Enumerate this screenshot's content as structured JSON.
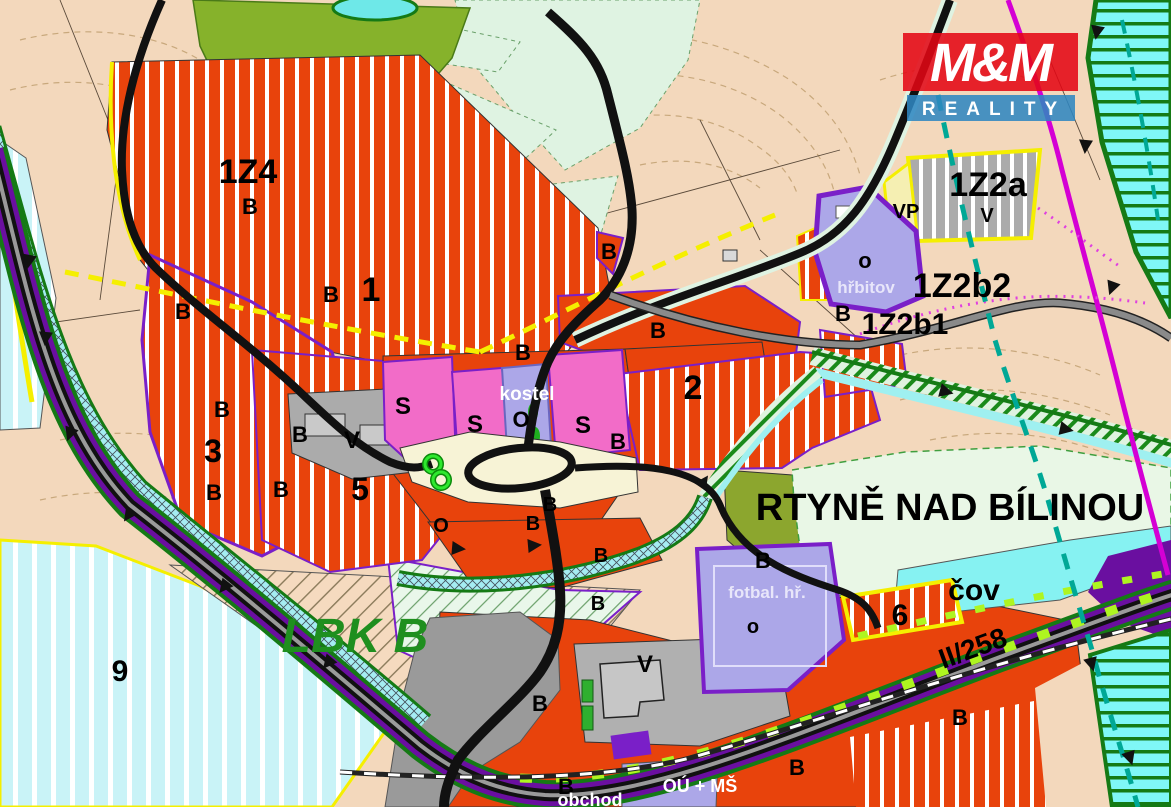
{
  "logo": {
    "mm": "M&M",
    "reality": "REALITY",
    "red": "#e30613",
    "blue": "#2e86c1"
  },
  "map": {
    "town_name": "RTYNĚ NAD BÍLINOU",
    "biocorridor_name": "LBK B",
    "road_code": "II/258",
    "labels": [
      {
        "t": "1Z4",
        "x": 248,
        "y": 183,
        "s": 34,
        "id": "zone-code-1z4"
      },
      {
        "t": "1Z2a",
        "x": 988,
        "y": 196,
        "s": 34,
        "id": "zone-code-1z2a"
      },
      {
        "t": "1Z2b2",
        "x": 962,
        "y": 297,
        "s": 34,
        "id": "zone-code-1z2b2"
      },
      {
        "t": "1Z2b1",
        "x": 905,
        "y": 334,
        "s": 30,
        "id": "zone-code-1z2b1"
      },
      {
        "t": "VP",
        "x": 906,
        "y": 218,
        "s": 20,
        "id": "zone-code-vp"
      },
      {
        "t": "1",
        "x": 371,
        "y": 301,
        "s": 34,
        "id": "area-1"
      },
      {
        "t": "2",
        "x": 693,
        "y": 399,
        "s": 34,
        "id": "area-2"
      },
      {
        "t": "3",
        "x": 213,
        "y": 462,
        "s": 32,
        "id": "area-3"
      },
      {
        "t": "5",
        "x": 360,
        "y": 500,
        "s": 32,
        "id": "area-5"
      },
      {
        "t": "6",
        "x": 900,
        "y": 625,
        "s": 30,
        "id": "area-6"
      },
      {
        "t": "9",
        "x": 120,
        "y": 681,
        "s": 30,
        "id": "area-9"
      },
      {
        "t": "B",
        "x": 250,
        "y": 214,
        "s": 22
      },
      {
        "t": "B",
        "x": 331,
        "y": 302,
        "s": 22
      },
      {
        "t": "B",
        "x": 183,
        "y": 319,
        "s": 22
      },
      {
        "t": "B",
        "x": 222,
        "y": 417,
        "s": 22
      },
      {
        "t": "B",
        "x": 300,
        "y": 442,
        "s": 22
      },
      {
        "t": "B",
        "x": 214,
        "y": 500,
        "s": 22
      },
      {
        "t": "B",
        "x": 281,
        "y": 497,
        "s": 22
      },
      {
        "t": "B",
        "x": 609,
        "y": 259,
        "s": 22
      },
      {
        "t": "B",
        "x": 523,
        "y": 360,
        "s": 22
      },
      {
        "t": "B",
        "x": 658,
        "y": 338,
        "s": 22
      },
      {
        "t": "B",
        "x": 618,
        "y": 449,
        "s": 22
      },
      {
        "t": "B",
        "x": 843,
        "y": 321,
        "s": 22
      },
      {
        "t": "B",
        "x": 763,
        "y": 568,
        "s": 22
      },
      {
        "t": "B",
        "x": 550,
        "y": 511,
        "s": 20
      },
      {
        "t": "B",
        "x": 533,
        "y": 530,
        "s": 20
      },
      {
        "t": "B",
        "x": 601,
        "y": 562,
        "s": 20
      },
      {
        "t": "B",
        "x": 598,
        "y": 610,
        "s": 20
      },
      {
        "t": "B",
        "x": 540,
        "y": 711,
        "s": 22
      },
      {
        "t": "B",
        "x": 797,
        "y": 775,
        "s": 22
      },
      {
        "t": "B",
        "x": 566,
        "y": 794,
        "s": 22
      },
      {
        "t": "B",
        "x": 960,
        "y": 725,
        "s": 22
      },
      {
        "t": "S",
        "x": 403,
        "y": 414,
        "s": 24
      },
      {
        "t": "S",
        "x": 475,
        "y": 432,
        "s": 24
      },
      {
        "t": "S",
        "x": 583,
        "y": 433,
        "s": 24
      },
      {
        "t": "V",
        "x": 352,
        "y": 448,
        "s": 24,
        "id": "v-label-west"
      },
      {
        "t": "V",
        "x": 987,
        "y": 222,
        "s": 20,
        "id": "v-label-1z2a"
      },
      {
        "t": "V",
        "x": 645,
        "y": 672,
        "s": 24,
        "id": "v-label-south"
      },
      {
        "t": "O",
        "x": 521,
        "y": 427,
        "s": 22,
        "id": "o-label-kostel"
      },
      {
        "t": "O",
        "x": 441,
        "y": 532,
        "s": 20,
        "id": "o-label-center"
      },
      {
        "t": "o",
        "x": 865,
        "y": 268,
        "s": 22,
        "id": "o-label-hrbitov"
      },
      {
        "t": "o",
        "x": 753,
        "y": 633,
        "s": 20,
        "id": "o-label-fotbal"
      },
      {
        "t": "kostel",
        "x": 527,
        "y": 400,
        "s": 19,
        "c": "#ffffff",
        "id": "name-kostel"
      },
      {
        "t": "hřbitov",
        "x": 866,
        "y": 293,
        "s": 17,
        "c": "#e8e6fa",
        "id": "name-hrbitov"
      },
      {
        "t": "fotbal. hř.",
        "x": 767,
        "y": 598,
        "s": 17,
        "c": "#e8e6fa",
        "id": "name-fotbal-hriste"
      },
      {
        "t": "OÚ + MŠ",
        "x": 700,
        "y": 792,
        "s": 18,
        "c": "#ffffff",
        "id": "name-ou-ms"
      },
      {
        "t": "obchod",
        "x": 590,
        "y": 806,
        "s": 18,
        "c": "#ffffff",
        "id": "name-obchod"
      },
      {
        "t": "čov",
        "x": 974,
        "y": 600,
        "s": 30,
        "id": "name-cov"
      },
      {
        "t": "RTYNĚ NAD BÍLINOU",
        "x": 950,
        "y": 520,
        "s": 38,
        "id": "town-name"
      },
      {
        "t": "LBK B",
        "x": 355,
        "y": 652,
        "s": 48,
        "c": "#1f8f1f",
        "it": true,
        "id": "biocorridor-label"
      },
      {
        "t": "II/258",
        "x": 976,
        "y": 657,
        "s": 28,
        "rot": -20,
        "id": "road-code-label"
      }
    ]
  },
  "colors": {
    "residential_orange": "#e8430c",
    "mixed_use_pink": "#f26cc8",
    "civic_lavender": "#aca7e8",
    "production_gray": "#ababab",
    "background_peach": "#f3d8bc",
    "meadow_mint": "#e9f7e6",
    "forest_olive": "#86b22b",
    "water_cyan": "#a5ecf2",
    "flood_zone_cyan": "#c9f3f7",
    "biocorridor_cyan": "#7ff7f7",
    "zone_border_purple": "#7a1fc8",
    "corridor_purple": "#6a0fa0",
    "boundary_yellow": "#f5ef00",
    "utility_magenta": "#d400d4",
    "limit_teal": "#00a896",
    "road_black": "#111111",
    "lime_dash": "#aef520",
    "logo_red": "#e30613",
    "logo_blue": "#2e86c1",
    "label_green": "#1f8f1f"
  }
}
